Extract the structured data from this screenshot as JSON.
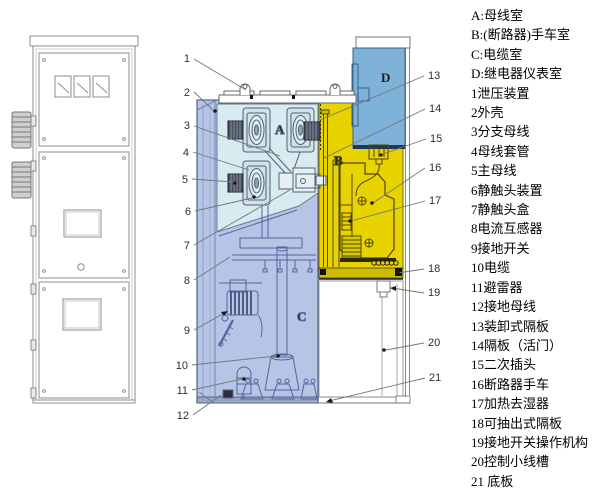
{
  "legend": {
    "items": [
      "A:母线室",
      "B:(断路器)手车室",
      "C:电缆室",
      "D:继电器仪表室",
      "1泄压装置",
      "2外壳",
      "3分支母线",
      "4母线套管",
      "5主母线",
      "6静触头装置",
      "7静触头盒",
      "8电流互感器",
      "9接地开关",
      "10电缆",
      "11避雷器",
      "12接地母线",
      "13装卸式隔板",
      "14隔板（活门）",
      "15二次插头",
      "16断路器手车",
      "17加热去湿器",
      "18可抽出式隔板",
      "19接地开关操作机构",
      "20控制小线槽",
      "21 底板"
    ]
  },
  "section": {
    "compartment_labels": {
      "a": "A",
      "b": "B",
      "c": "C",
      "d": "D"
    },
    "callouts_left": [
      "1",
      "2",
      "3",
      "4",
      "5",
      "6",
      "7",
      "8",
      "9",
      "10",
      "11",
      "12"
    ],
    "callouts_right": [
      "13",
      "14",
      "15",
      "16",
      "17",
      "18",
      "19",
      "20",
      "21"
    ]
  },
  "colors": {
    "busbar_room": "#d7ebf0",
    "breaker_room": "#e8d200",
    "cable_room": "#b6c4e6",
    "relay_room": "#7fb2d9",
    "rail_dark": "#cdbd00",
    "metal_dark": "#474e5e"
  }
}
